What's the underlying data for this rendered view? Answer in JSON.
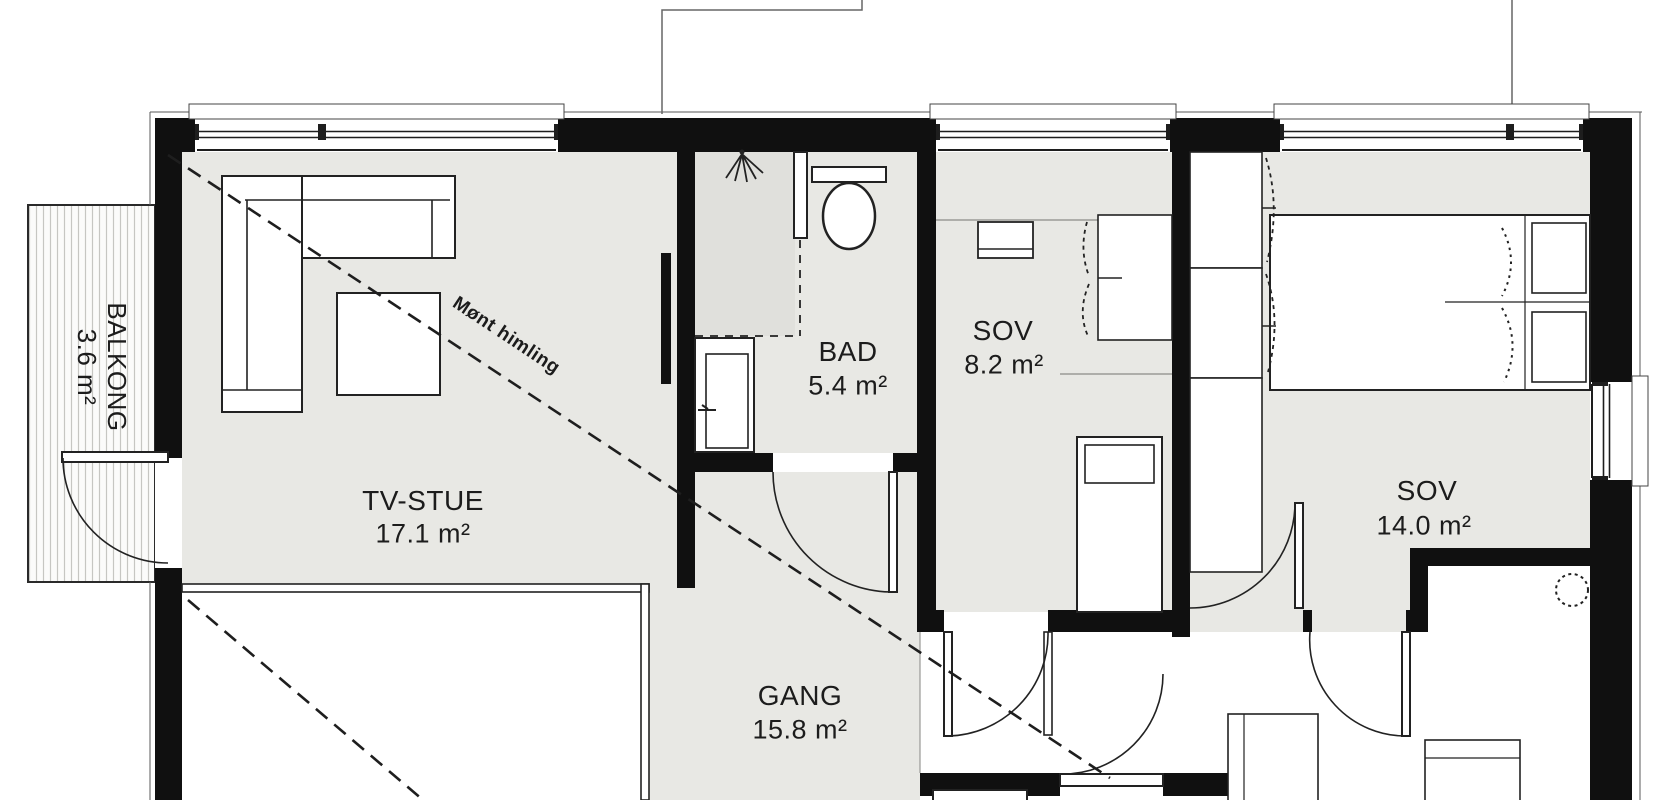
{
  "plan": {
    "title": "Floor plan",
    "rooms": [
      {
        "id": "tv_stue",
        "name": "TV-STUE",
        "area": "17.1 m²"
      },
      {
        "id": "bad",
        "name": "BAD",
        "area": "5.4 m²"
      },
      {
        "id": "sov_1",
        "name": "SOV",
        "area": "8.2 m²"
      },
      {
        "id": "sov_2",
        "name": "SOV",
        "area": "14.0 m²"
      },
      {
        "id": "gang",
        "name": "GANG",
        "area": "15.8 m²"
      },
      {
        "id": "balkong",
        "name": "BALKONG",
        "area": "3.6 m²"
      }
    ],
    "annotations": {
      "ceiling_note": "Mønt himling"
    },
    "colors": {
      "wall": "#101010",
      "floor_grey": "#e8e8e4",
      "shower_floor": "#e0e0dc",
      "room_white": "#ffffff",
      "line": "#222222"
    }
  }
}
